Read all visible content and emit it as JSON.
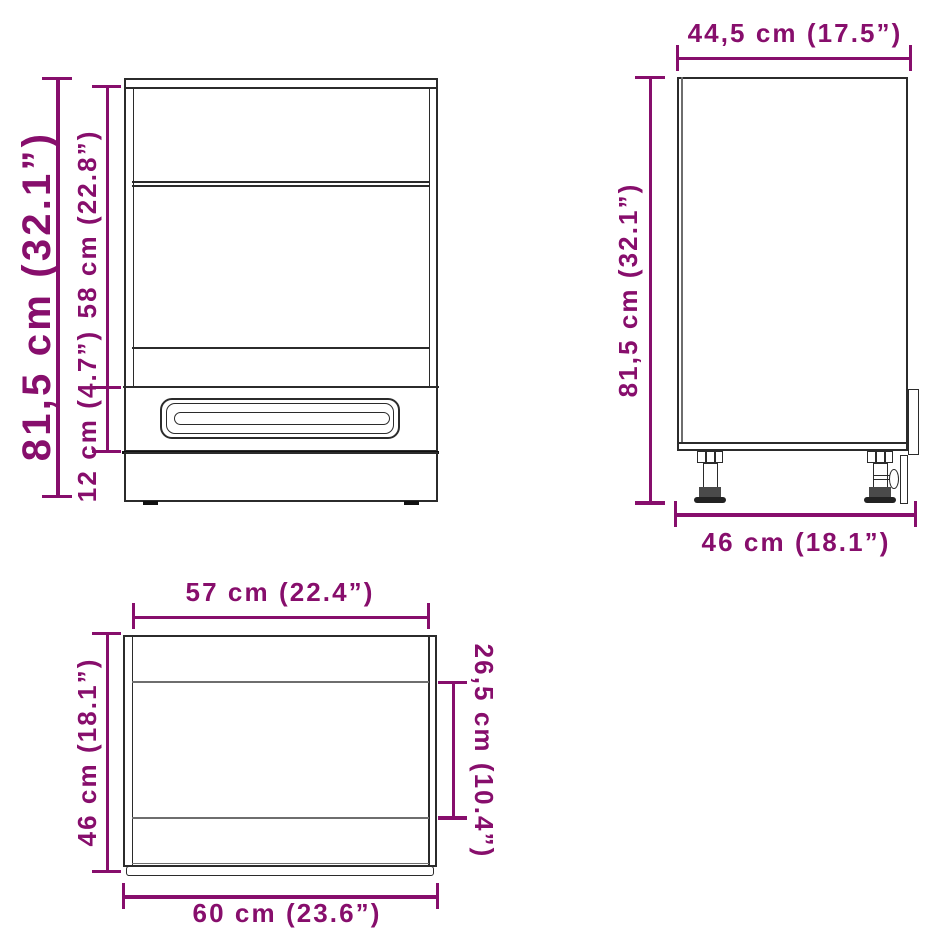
{
  "colors": {
    "dimension": "#870E6C",
    "outline": "#2b2b2b",
    "background": "#ffffff"
  },
  "front_view": {
    "total_height": "81,5 cm (32.1”)",
    "upper_section_height": "58 cm (22.8”)",
    "drawer_height": "12 cm (4.7”)"
  },
  "side_view": {
    "top_depth": "44,5 cm (17.5”)",
    "height": "81,5 cm (32.1”)",
    "bottom_depth": "46 cm (18.1”)"
  },
  "top_view": {
    "inner_width": "57 cm (22.4”)",
    "side_depth": "46 cm (18.1”)",
    "front_section_depth": "26,5 cm (10.4”)",
    "outer_width": "60 cm (23.6”)"
  }
}
